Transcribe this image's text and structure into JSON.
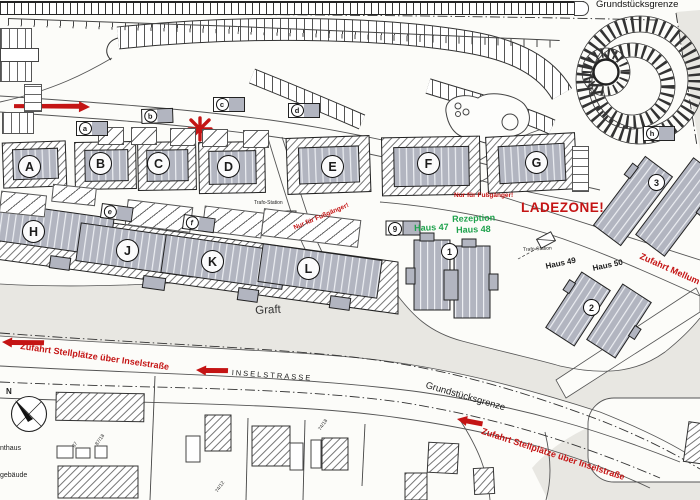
{
  "boundary": {
    "top": "Grundstücksgrenze",
    "road": "Grundstücksgrenze"
  },
  "water": {
    "graft": "Graft"
  },
  "streets": {
    "inselstrasse": "INSELSTRASSE"
  },
  "red_notes": {
    "ladezone": "LADEZONE!",
    "pedestrian_path": "Nur für Fußgänger!",
    "pedestrian_zone": "Nur für Fußgänger!",
    "access_left": "Zufahrt Stellplätze über Inselstraße",
    "access_right": "Zufahrt Stellplätze über Inselstraße",
    "access_mellum": "Zufahrt Mellum"
  },
  "reception": {
    "rezeption": "Rezeption",
    "haus48": "Haus 48",
    "haus47": "Haus 47"
  },
  "houses": {
    "haus49": "Haus 49",
    "haus50": "Haus 50"
  },
  "trafo": {
    "station1": "Trafo-Station",
    "station2": "Trafo-Station"
  },
  "buildings": {
    "top_row": [
      "A",
      "B",
      "C",
      "D",
      "E",
      "F",
      "G"
    ],
    "waterfront_row": [
      "H",
      "J",
      "K",
      "L"
    ]
  },
  "unit_markers": {
    "m1": "1",
    "m2": "2",
    "m3": "3",
    "m9": "9"
  },
  "garage_markers": [
    "a",
    "b",
    "c",
    "d",
    "e",
    "f",
    "h"
  ],
  "compass": {
    "north": "N"
  },
  "cut_labels": {
    "nthaus": "nthaus",
    "gebaeude": "gebäude"
  },
  "parcels": {
    "p87": "87",
    "p87_18": "87/18",
    "p74_18": "74/18",
    "p74_12": "74/12"
  },
  "colors": {
    "red": "#c41414",
    "green": "#1fa24d",
    "building": "#b2b5c0",
    "water": "#e8e7e2"
  }
}
